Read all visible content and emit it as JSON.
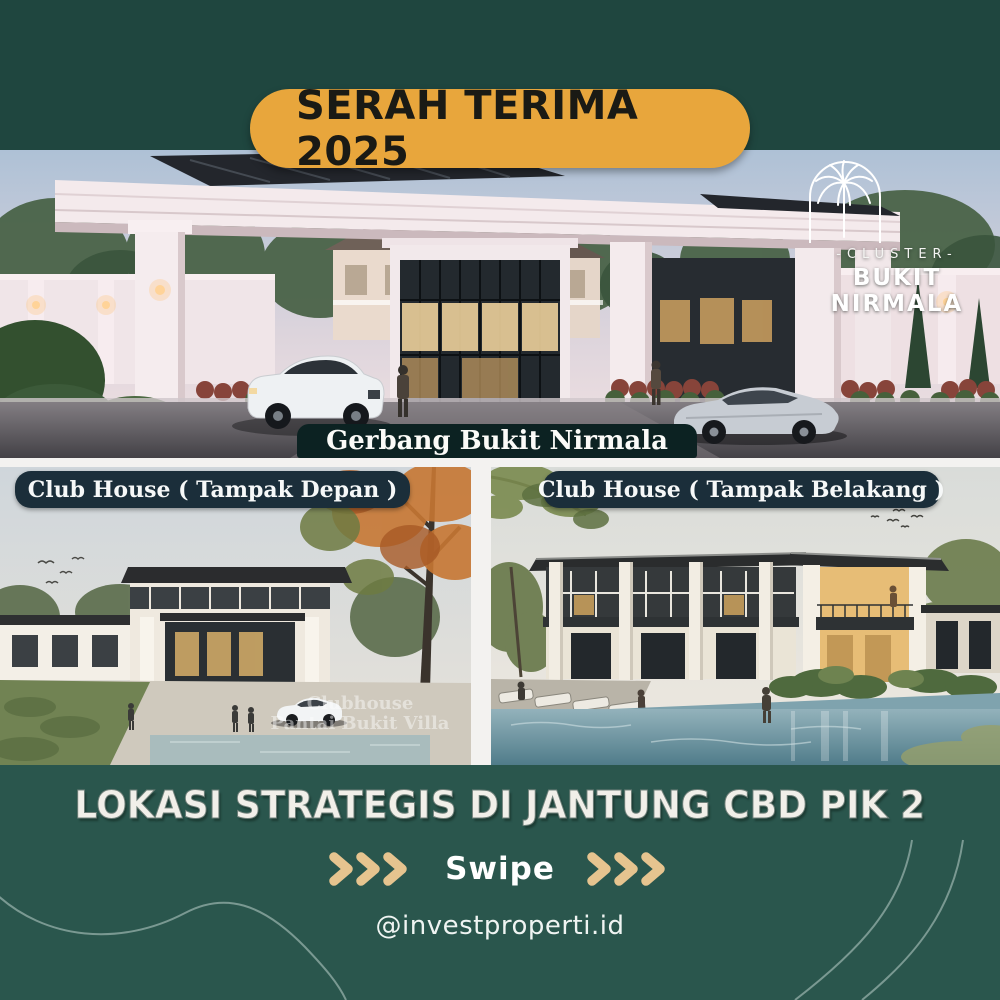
{
  "post": {
    "badge_label": "SERAH TERIMA 2025",
    "logo": {
      "tagline": "-CLUSTER-",
      "name": "BUKIT NIRMALA"
    },
    "gate_photo": {
      "caption": "Gerbang Bukit Nirmala"
    },
    "club_front_photo": {
      "label": "Club House ( Tampak Depan )",
      "watermark_line1": "Clubhouse",
      "watermark_line2": "Pantai Bukit Villa"
    },
    "club_back_photo": {
      "label": "Club House ( Tampak Belakang )"
    },
    "footer": {
      "headline": "LOKASI STRATEGIS DI JANTUNG CBD PIK 2",
      "swipe_label": "Swipe",
      "handle": "@investproperti.id"
    },
    "colors": {
      "background_teal": "#1F463F",
      "bottom_teal": "#2A564D",
      "badge_gold": "#E8A63C",
      "chevron_tan": "#E6C48F",
      "label_navy": "#1B2E3A",
      "caption_dark": "#0C2222",
      "frame_white": "#F3F2F0"
    }
  }
}
